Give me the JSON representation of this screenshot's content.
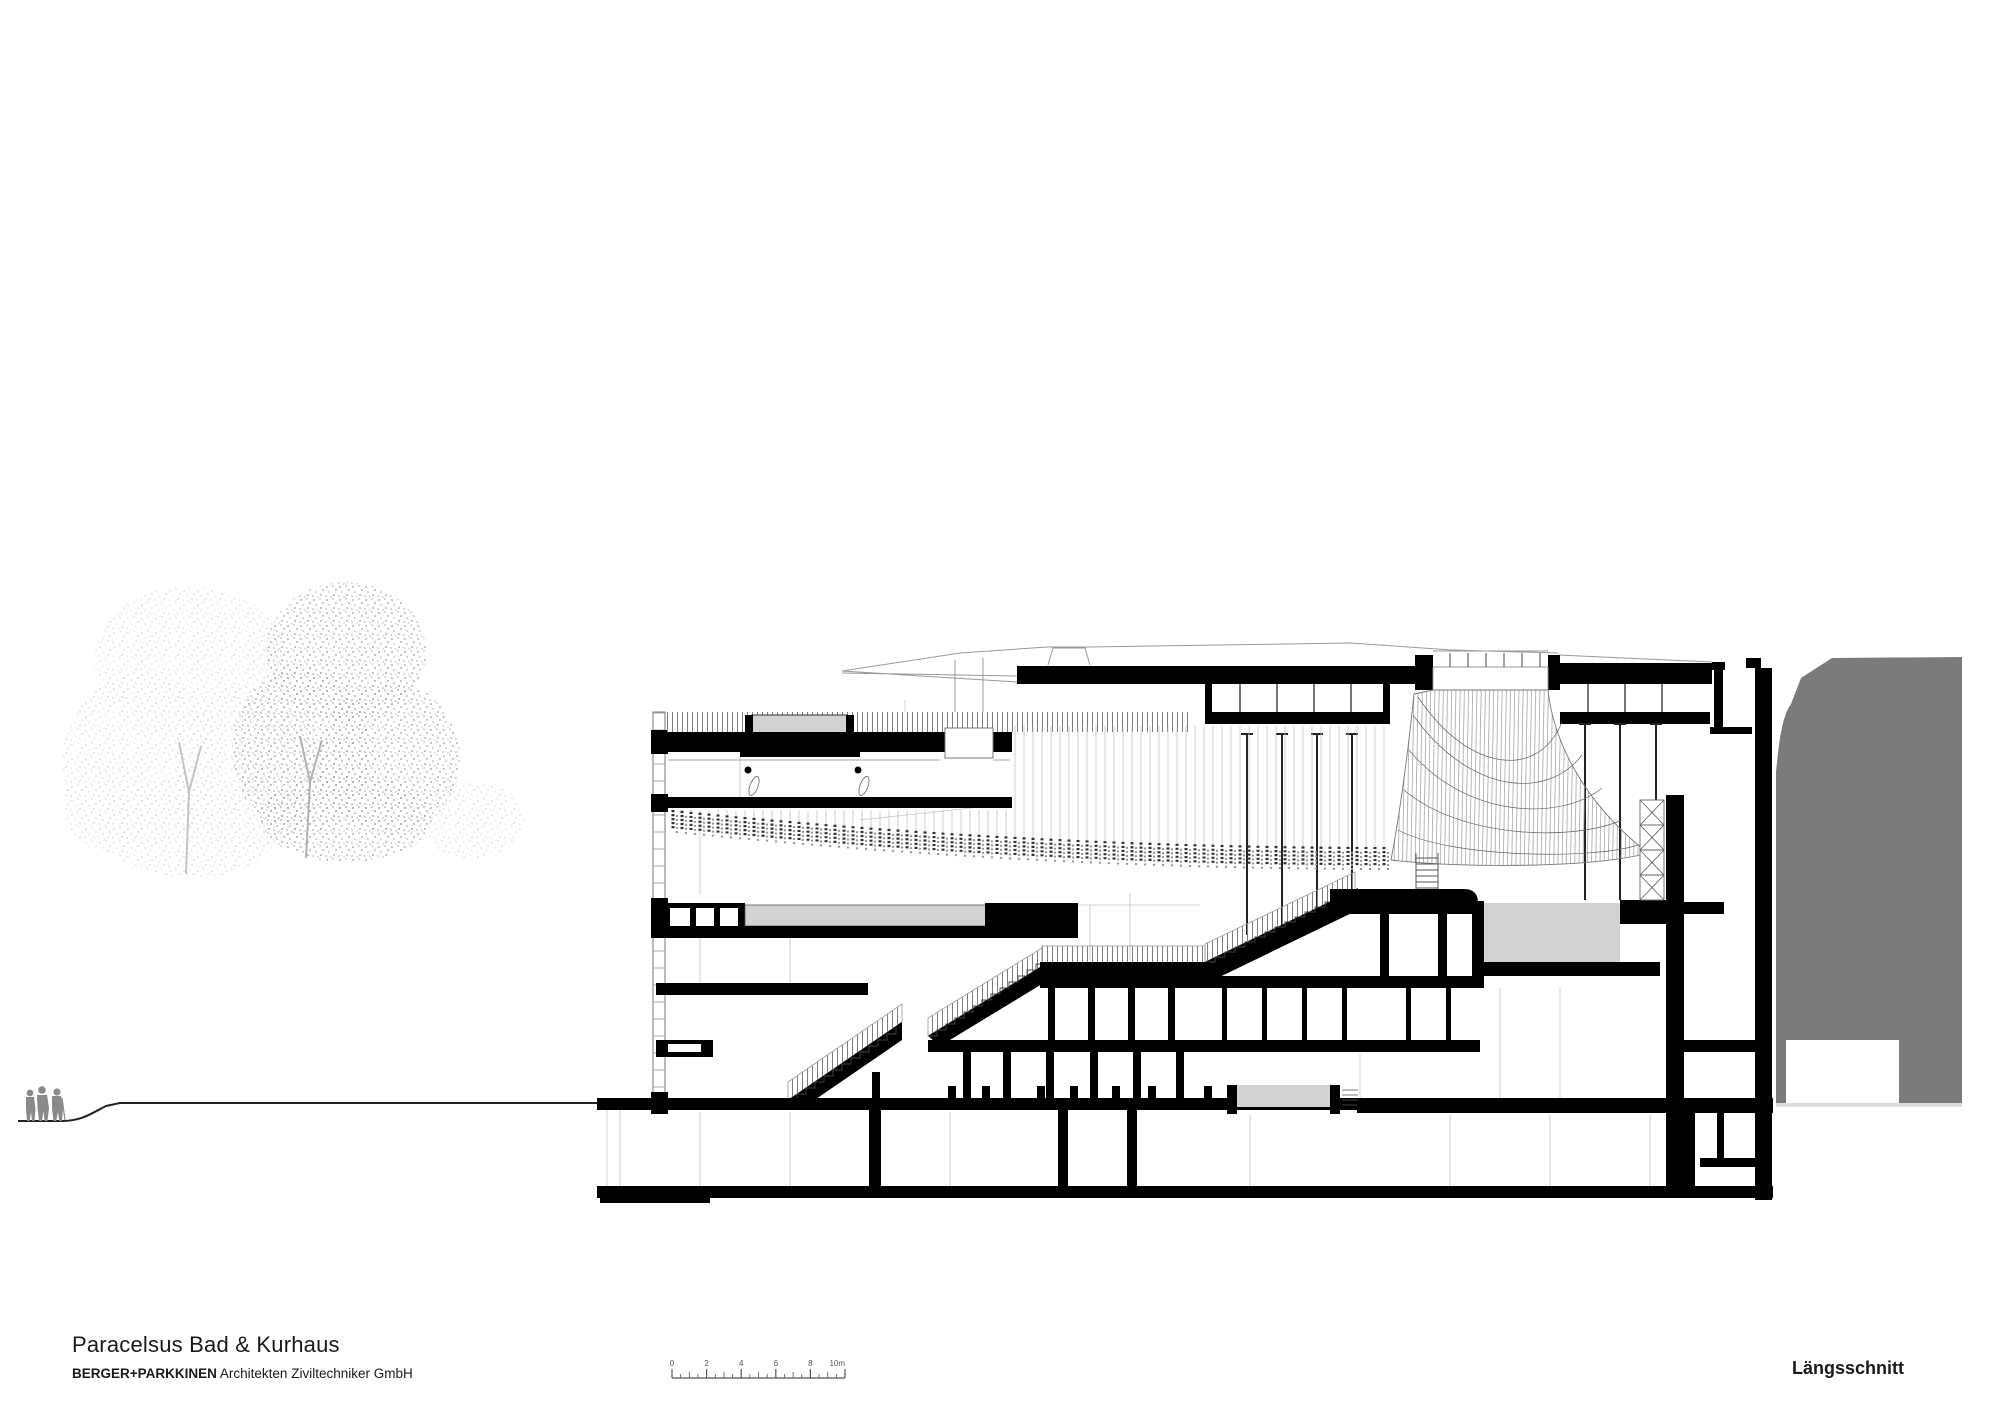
{
  "title_block": {
    "project": "Paracelsus Bad & Kurhaus",
    "firm_bold": "BERGER+PARKKINEN",
    "firm_rest": " Architekten Ziviltechniker GmbH",
    "drawing_name": "Längsschnitt"
  },
  "scale_bar": {
    "unit_labels": [
      "0",
      "2",
      "4",
      "6",
      "8",
      "10m"
    ],
    "meters_total": 10,
    "px_per_meter": 17.3,
    "x0": 672,
    "baseline_y": 1378
  },
  "drawing": {
    "colors": {
      "poche_black": "#000000",
      "thin_line": "#888888",
      "faint_line": "#c0c0c0",
      "pool_gray": "#d2d2d2",
      "context_mass_gray": "#7b7b7b",
      "figure_gray": "#8a8a8a",
      "tree_light": "#cfcfcf",
      "tree_dark": "#9e9e9e",
      "background": "#ffffff"
    },
    "curtain": {
      "x_start": 673,
      "x_end": 1392,
      "spacing": 9
    }
  }
}
